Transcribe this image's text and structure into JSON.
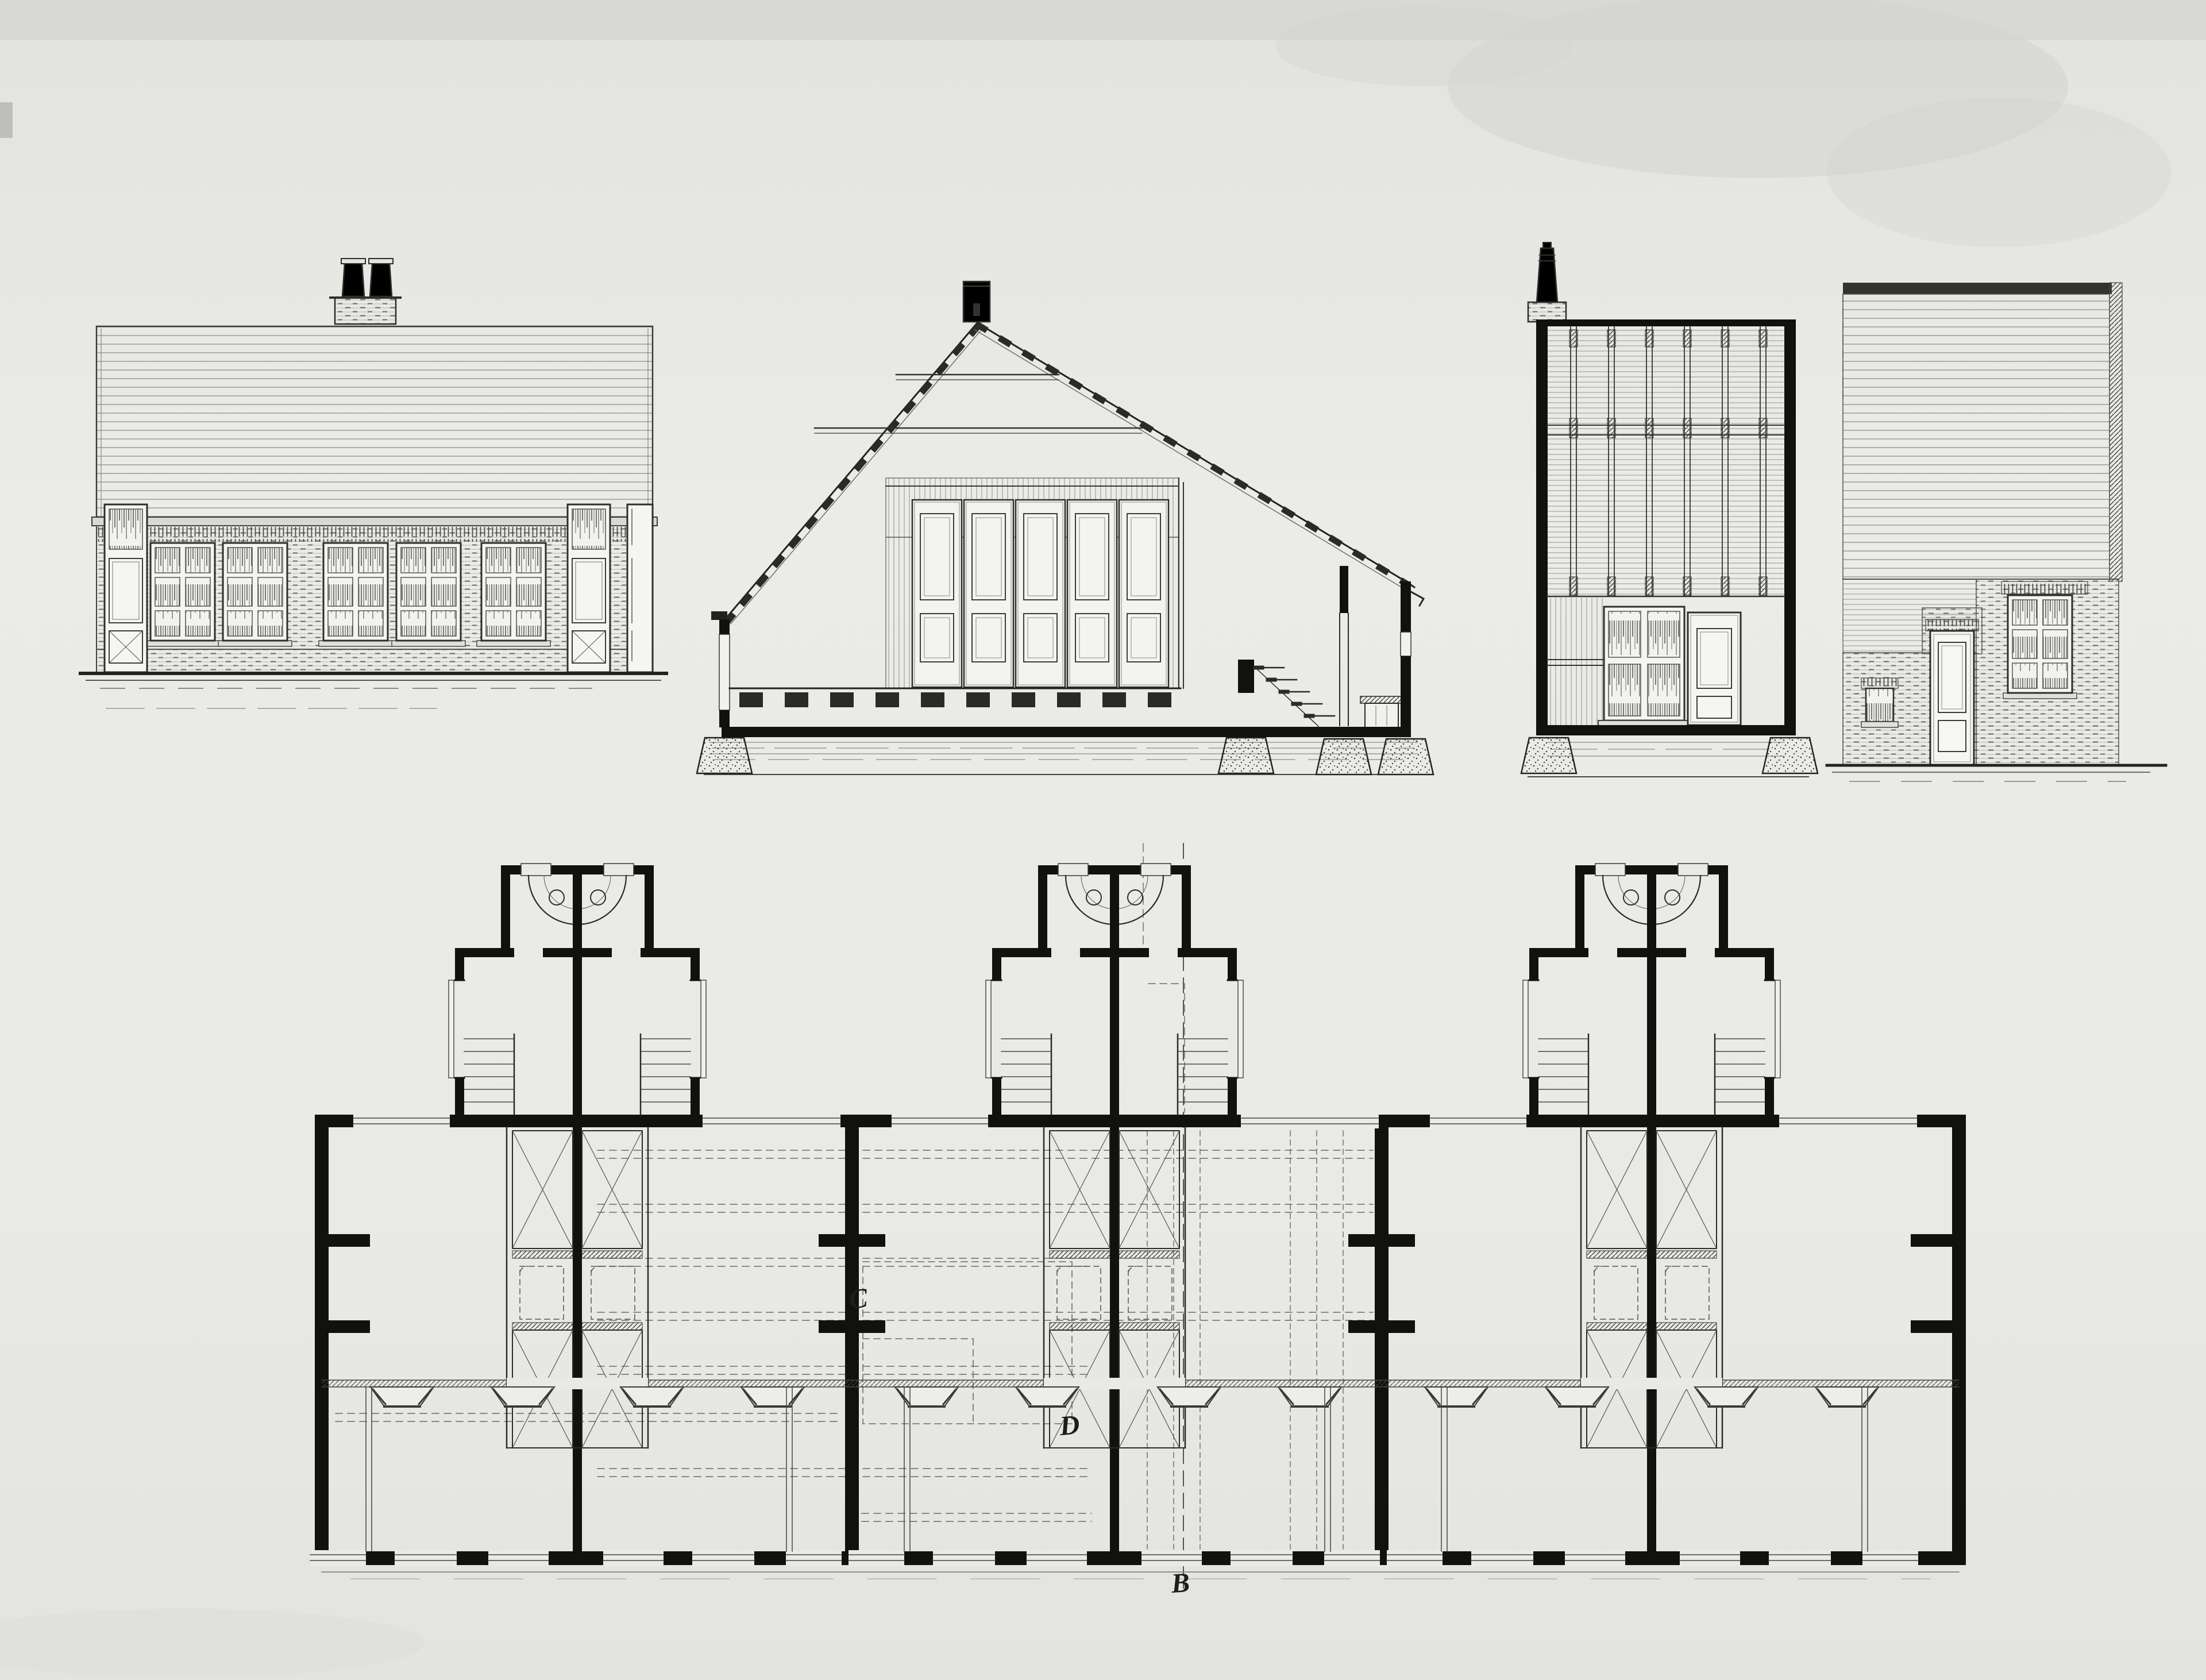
{
  "sheet": {
    "kind": "scanned architectural drawing",
    "content": "three paired one-storey dwellings: front elevation, two cross sections, rear elevation and ground-floor plan",
    "visible_text_note": "the only text rendered on the sheet is three cursive section letters on the floor plan"
  },
  "palette": {
    "paper": "#e9e9e6",
    "paper_edge": "#dededa",
    "ink": "#1c1c1a",
    "ink_light": "#6f6f6a",
    "stain": "#d2d2ce"
  },
  "plan": {
    "section_labels": [
      {
        "glyph": "C",
        "position": "left of the pair-dividing wall, middle of plan"
      },
      {
        "glyph": "D",
        "position": "corner of dashed upper-floor outline, centre unit"
      },
      {
        "glyph": "B",
        "position": "below the front wall on the dashed section line"
      }
    ]
  },
  "drawings": [
    {
      "id": "front-elevation",
      "features": [
        "double chimney",
        "horizontal-boarded roof face",
        "brick plinth",
        "five six-pane windows",
        "two panelled doors"
      ]
    },
    {
      "id": "cross-section",
      "features": [
        "gable roof with battens",
        "apex chimney",
        "five panelled cupboard doors",
        "floor joists",
        "cellar stair",
        "lean-to",
        "stippled footings"
      ]
    },
    {
      "id": "roof-structure-section",
      "features": [
        "corner chimney",
        "rafter and boarding ceiling",
        "boarded wall",
        "four-pane window",
        "panelled door"
      ]
    },
    {
      "id": "rear-elevation",
      "features": [
        "clapboard upper wall",
        "brick lower wall",
        "six-pane window",
        "small single window",
        "panelled door"
      ]
    },
    {
      "id": "ground-floor-plan",
      "features": [
        "three rear annexes with privies",
        "twin stairs per annex",
        "cupboard-bed cores with X bracing",
        "dashed attic overlay",
        "front room strip with splayed openings"
      ]
    }
  ]
}
